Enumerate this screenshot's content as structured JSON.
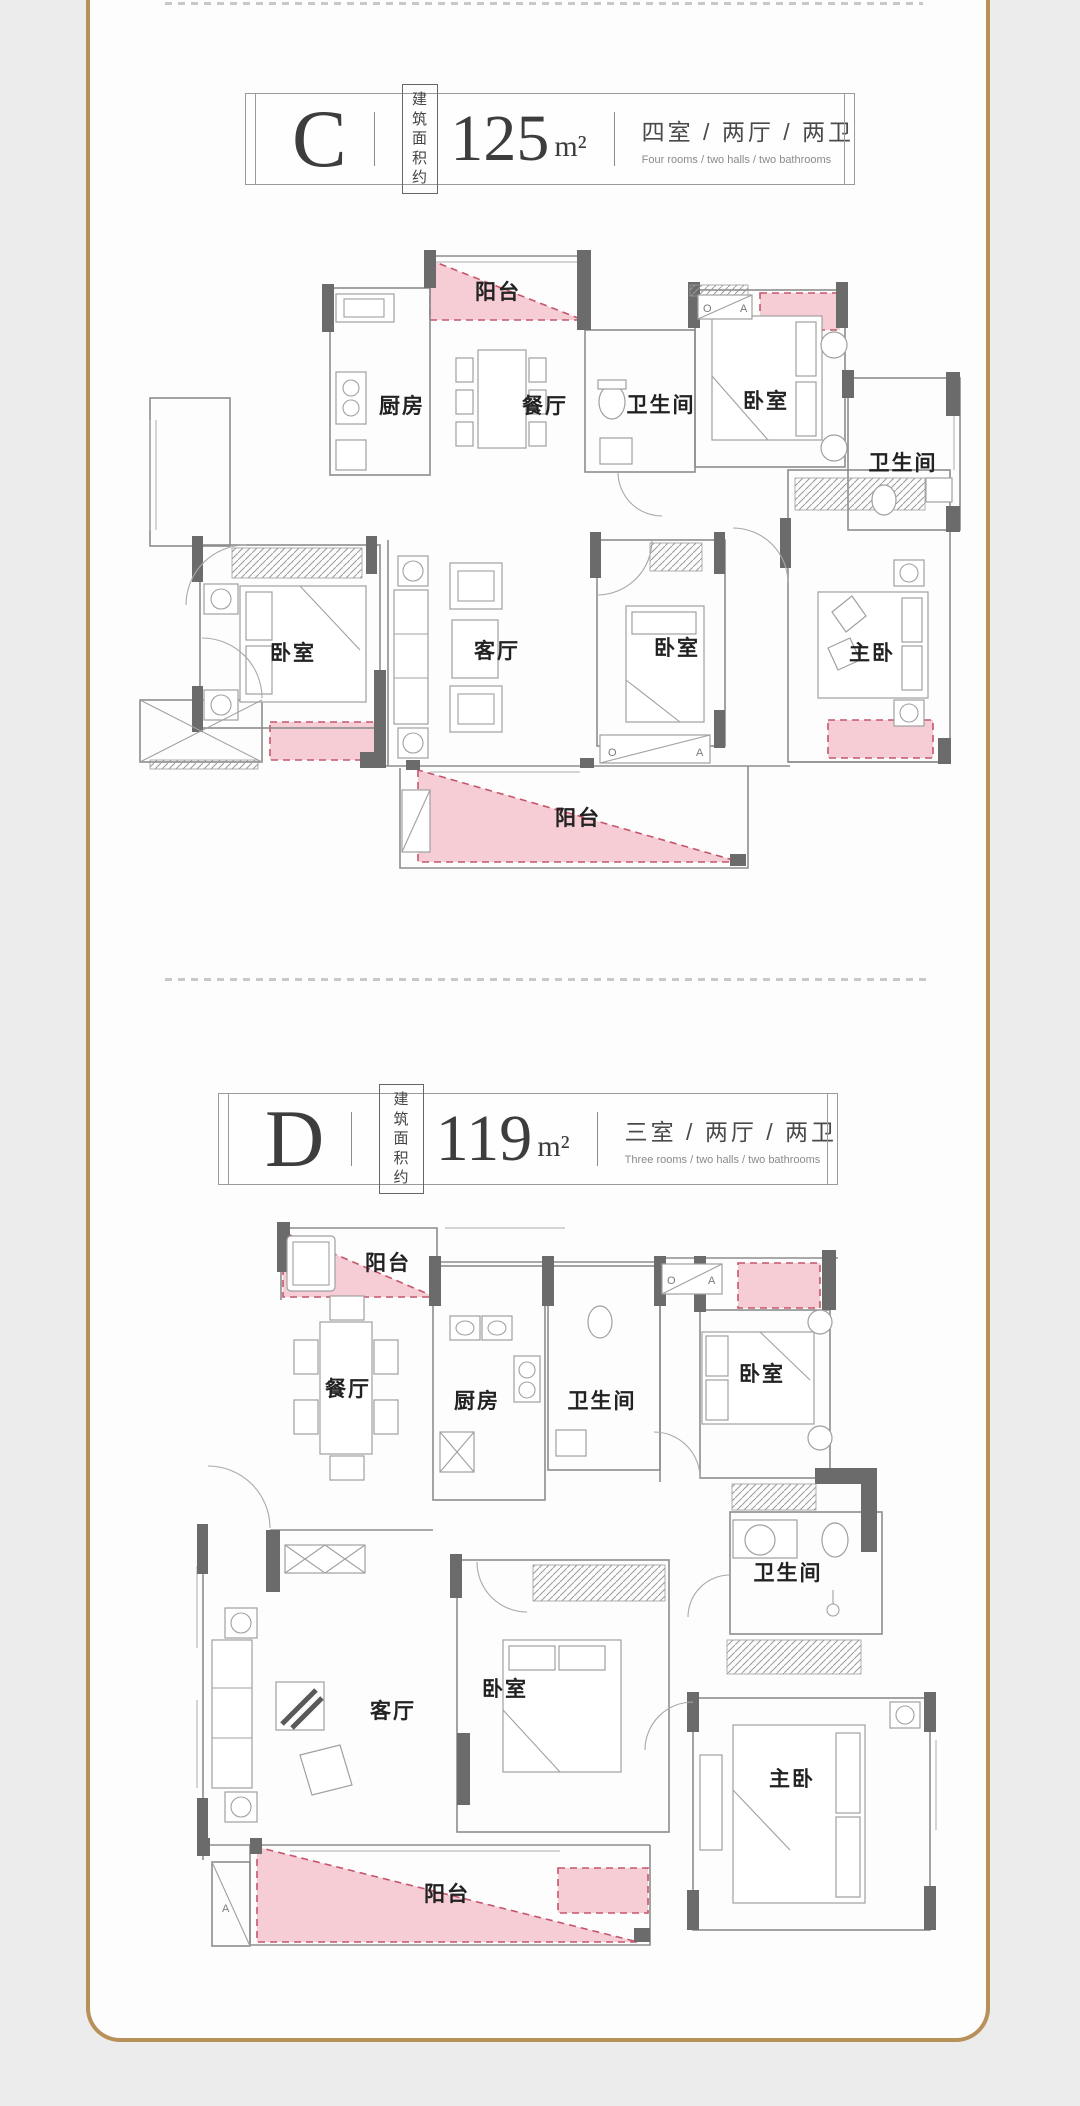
{
  "theme": {
    "page_background": "#ececec",
    "card_background": "#fdfdfd",
    "frame_gold": "#b8905a",
    "balcony_pink_fill": "#f7cdd5",
    "balcony_pink_border": "#c4566c",
    "wall_dark": "#6b6b6b",
    "wall_light": "#8d8d8d",
    "label_color": "#222222"
  },
  "plan_c": {
    "letter": "C",
    "area_prefix_line1": "建筑",
    "area_prefix_line2": "面积约",
    "area_value": "125",
    "area_unit": "m²",
    "layout_cn": "四室 / 两厅 / 两卫",
    "layout_en": "Four rooms / two halls / two bathrooms",
    "rooms": {
      "balcony_top": "阳台",
      "kitchen": "厨房",
      "dining": "餐厅",
      "bath_1": "卫生间",
      "bedroom_top": "卧室",
      "bath_2": "卫生间",
      "bedroom_left": "卧室",
      "living": "客厅",
      "bedroom_mid": "卧室",
      "master": "主卧",
      "balcony_bottom": "阳台"
    },
    "mark_o": "O",
    "mark_a": "A"
  },
  "plan_d": {
    "letter": "D",
    "area_prefix_line1": "建筑",
    "area_prefix_line2": "面积约",
    "area_value": "119",
    "area_unit": "m²",
    "layout_cn": "三室 / 两厅 / 两卫",
    "layout_en": "Three rooms / two halls / two bathrooms",
    "rooms": {
      "balcony_top": "阳台",
      "dining": "餐厅",
      "kitchen": "厨房",
      "bath_1": "卫生间",
      "bedroom_top": "卧室",
      "living": "客厅",
      "bedroom_mid": "卧室",
      "bath_2": "卫生间",
      "master": "主卧",
      "balcony_bottom": "阳台"
    },
    "mark_o": "O",
    "mark_a": "A"
  }
}
